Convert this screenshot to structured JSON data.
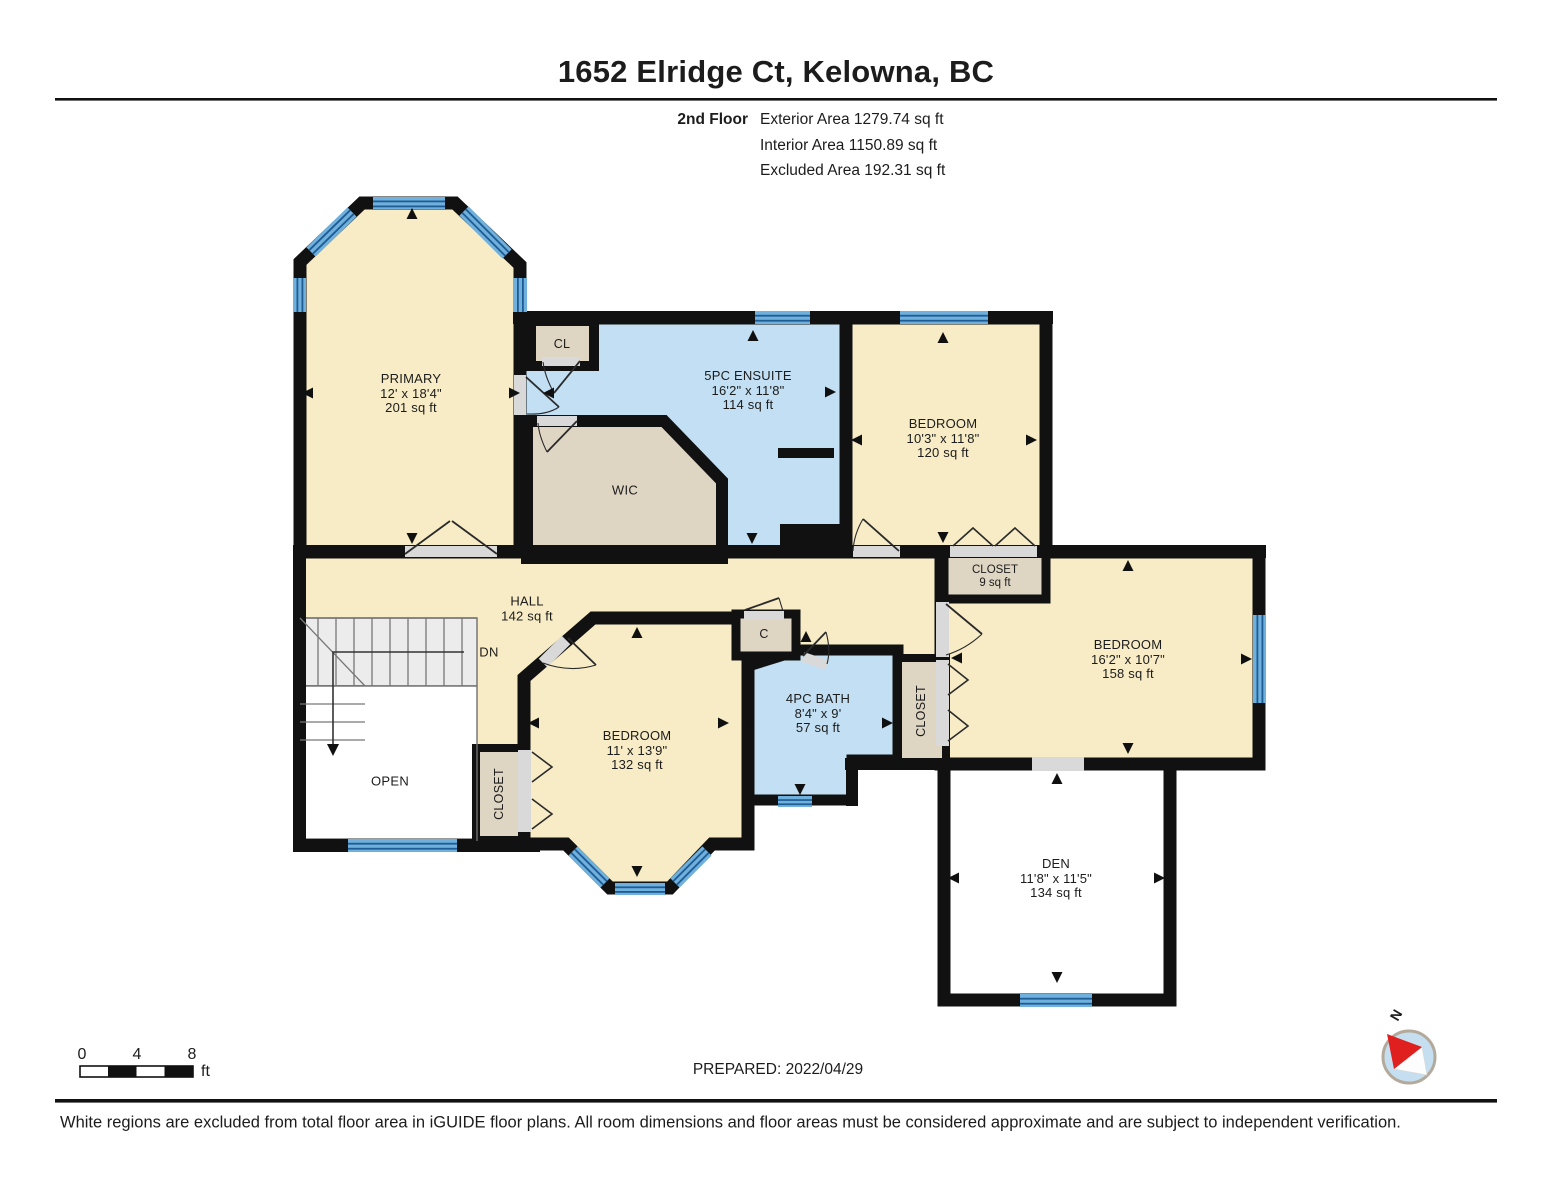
{
  "header": {
    "title": "1652 Elridge Ct, Kelowna, BC",
    "floor_label": "2nd Floor",
    "exterior_area": "Exterior Area 1279.74 sq ft",
    "interior_area": "Interior Area 1150.89 sq ft",
    "excluded_area": "Excluded Area 192.31 sq ft"
  },
  "rooms": {
    "primary": {
      "name": "PRIMARY",
      "dims": "12' x 18'4\"",
      "area": "201 sq ft"
    },
    "ensuite": {
      "name": "5PC ENSUITE",
      "dims": "16'2\" x 11'8\"",
      "area": "114 sq ft"
    },
    "bedroom_top": {
      "name": "BEDROOM",
      "dims": "10'3\" x 11'8\"",
      "area": "120 sq ft"
    },
    "bedroom_right": {
      "name": "BEDROOM",
      "dims": "16'2\" x 10'7\"",
      "area": "158 sq ft"
    },
    "bedroom_middle": {
      "name": "BEDROOM",
      "dims": "11' x 13'9\"",
      "area": "132 sq ft"
    },
    "bath": {
      "name": "4PC BATH",
      "dims": "8'4\" x 9'",
      "area": "57 sq ft"
    },
    "den": {
      "name": "DEN",
      "dims": "11'8\" x 11'5\"",
      "area": "134 sq ft"
    },
    "hall": {
      "name": "HALL",
      "area": "142 sq ft"
    },
    "closet_small": {
      "name": "CLOSET",
      "area": "9 sq ft"
    }
  },
  "labels": {
    "wic": "WIC",
    "cl": "CL",
    "c": "C",
    "dn": "DN",
    "open": "OPEN",
    "closet_middle": "CLOSET",
    "closet_right": "CLOSET",
    "north": "N"
  },
  "scale_bar": {
    "tick_0": "0",
    "tick_4": "4",
    "tick_8": "8",
    "unit": "ft"
  },
  "footer": {
    "prepared": "PREPARED: 2022/04/29",
    "disclaimer": "White regions are excluded from total floor area in iGUIDE floor plans. All room dimensions and floor areas must be considered approximate and are subject to independent verification."
  },
  "colors": {
    "wall": "#111111",
    "room_beige": "#f7ecc6",
    "room_blue": "#c2dff3",
    "closet_taupe": "#ded5c3",
    "window_light": "#6fb0dd",
    "window_dark": "#1f5c94",
    "stairs_grey": "#ececec",
    "door_sill": "#d9d9d9",
    "compass_red": "#e01f1f",
    "compass_blue": "#c5dff0"
  }
}
